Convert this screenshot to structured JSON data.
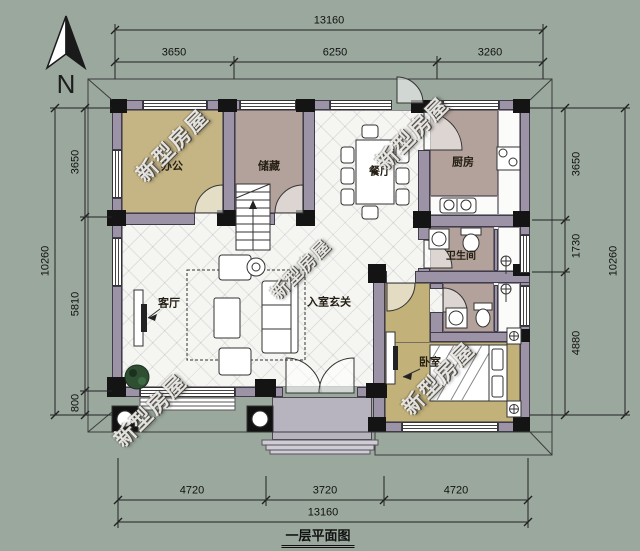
{
  "plan": {
    "title": "一层平面图",
    "north_label": "N",
    "watermark": "新型房屋",
    "rooms": {
      "office": "办公",
      "storage": "储藏",
      "dining": "餐厅",
      "kitchen": "厨房",
      "bathroom": "卫生间",
      "living": "客厅",
      "foyer": "入室玄关",
      "bedroom": "卧室"
    },
    "dims": {
      "top": {
        "total": "13160",
        "segments": [
          "3650",
          "6250",
          "3260"
        ]
      },
      "bottom": {
        "total": "13160",
        "segments": [
          "4720",
          "3720",
          "4720"
        ]
      },
      "left": {
        "total": "10260",
        "segments": [
          "3650",
          "5810",
          "800"
        ]
      },
      "right": {
        "total": "10260",
        "segments": [
          "3650",
          "1730",
          "4880"
        ]
      }
    },
    "colors": {
      "bg": "#9aa89e",
      "wall": "#9c94a6",
      "wall-dark": "#141414",
      "floor-olive": "#c6b584",
      "floor-olive2": "#c2b179",
      "floor-mauve": "#b3a29b",
      "tile": "#f5f5f2",
      "porch": "#b7b4bf",
      "line": "#2a2a2a",
      "plant": "#2f4f33"
    }
  }
}
